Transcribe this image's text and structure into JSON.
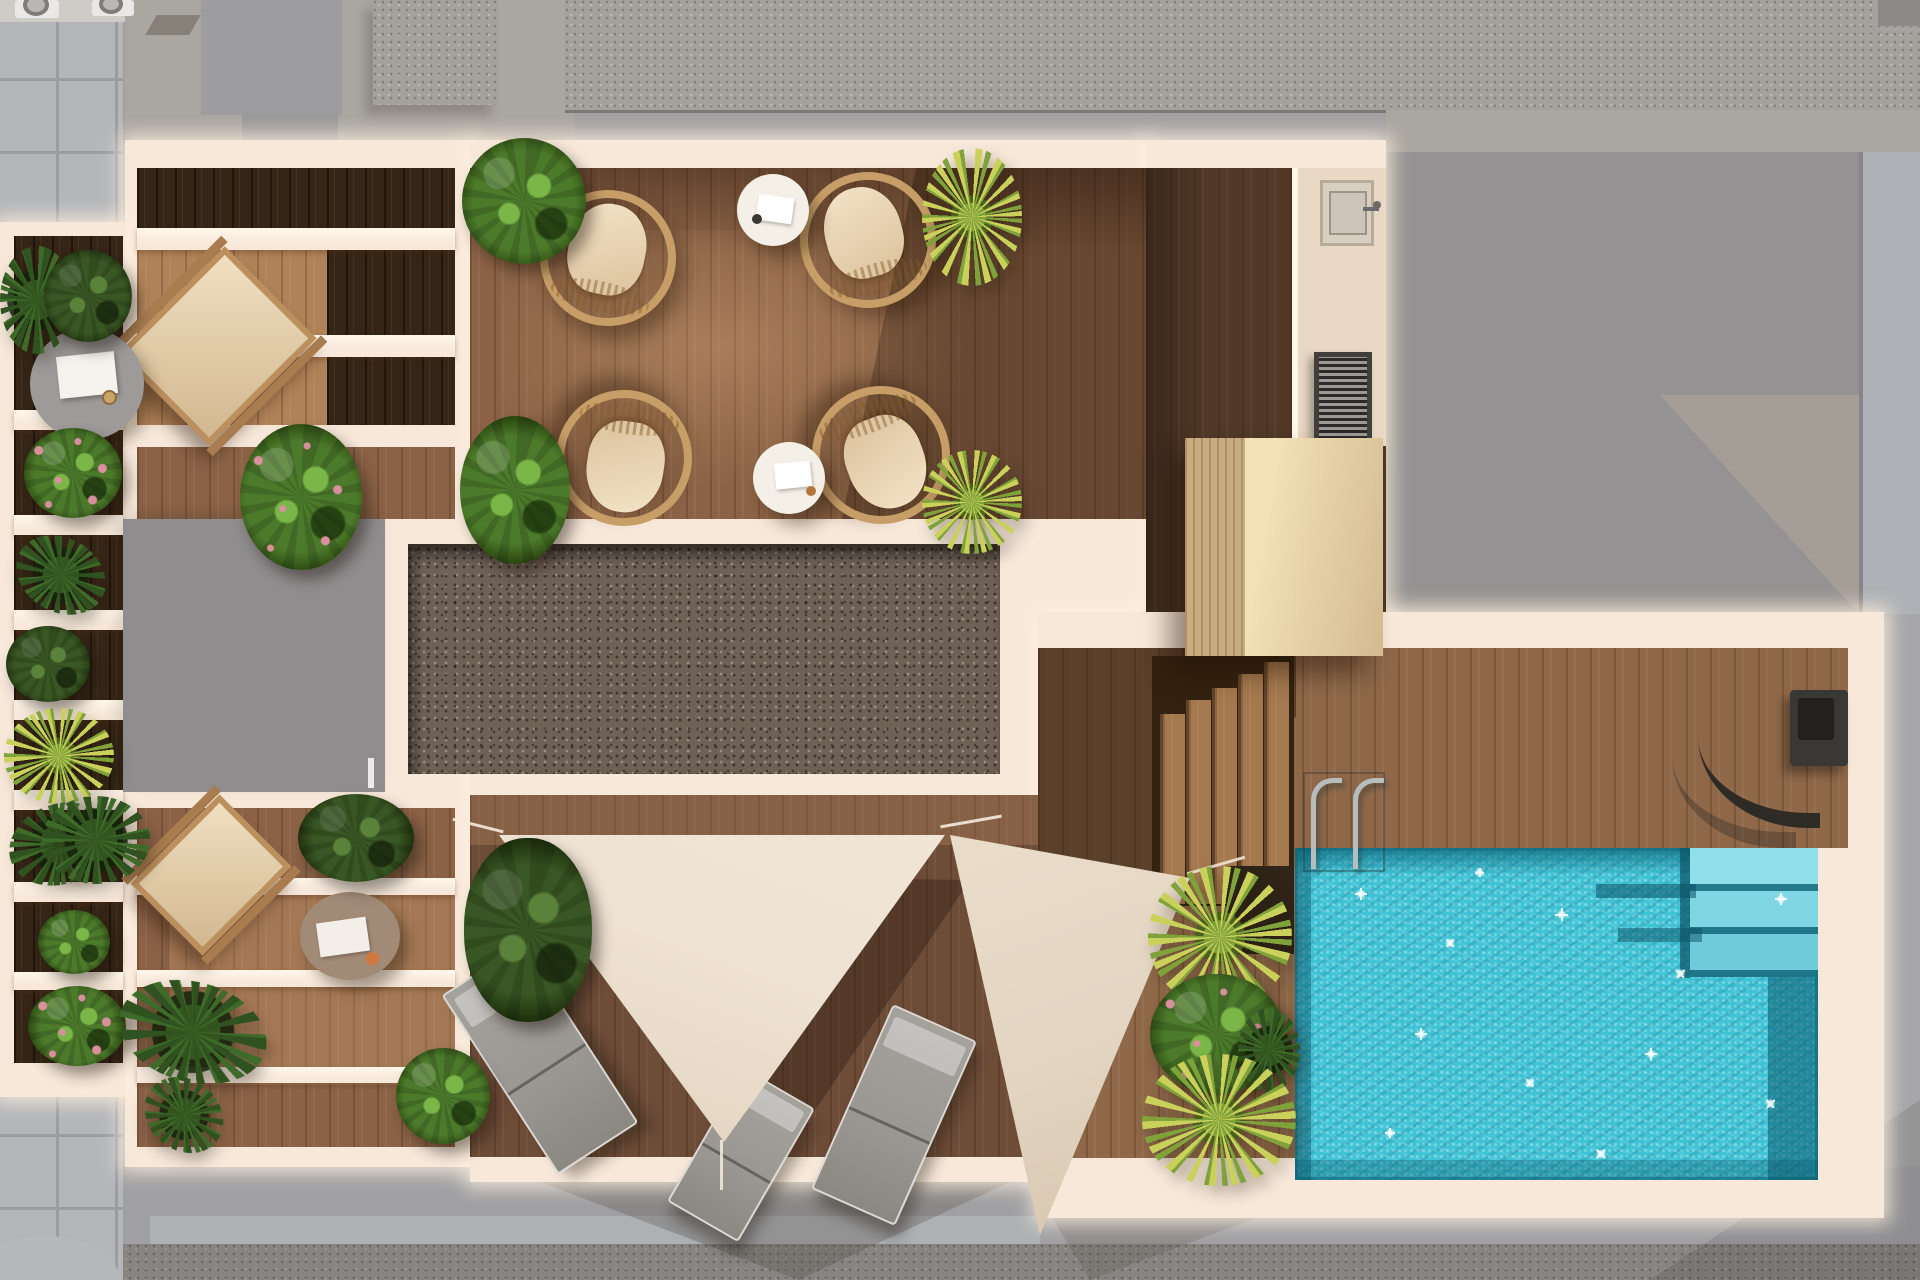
{
  "scene": {
    "title": "rooftop-terrace-floor-plan",
    "type": "architectural-top-down-3d-render",
    "description": "Top-down 3D architectural rendering of a rooftop terrace with swimming pool, wooden decks, pergola planters, gravel roof inset, shade sails and lounge furniture, surrounded by neighbouring grey rooftops"
  },
  "palette": {
    "cream": "#f7e8da",
    "creamBright": "#fff6ea",
    "surround": "#a2a0a2",
    "surroundDark": "#8e8c8b",
    "surroundLight": "#aeb1b4",
    "rightGray": "#949292",
    "rightGrayLight": "#a59e97",
    "rightBand": "#aeb1b5",
    "pavement": "#b4b6ba",
    "pavementLine": "#9b9da1",
    "speckRoof": "#a5a19d",
    "warmGray": "#aaa6a0",
    "roofBlock": "#9d9c9e",
    "grayBox": "#8f8d8e",
    "gravel": "#6e6156",
    "woodDark": "#352516",
    "deckMain": "#8b6246",
    "deckLight": "#b08257",
    "deckBottom": "#6d4c38",
    "deckPool": "#8f6849",
    "deckShadow": "#513827",
    "platformA": "#f2e0b6",
    "platformB": "#d9b67e",
    "concrete": "#e9d8c3",
    "steel": "#cdc5b9",
    "grillDark": "#413f3c",
    "poolWater": "#41c3d6",
    "poolDark": "#117e95",
    "poolShadow": "#0c6d82",
    "poolStep": "#8fe0ea",
    "sailA": "#eee2d2",
    "sailB": "#e3d5c2",
    "lounger": "#9a9792",
    "loungerEdge": "#dcd9d4",
    "wicker": "#c79e67",
    "cushion": "#efddc0",
    "tableWhite": "#f4efe7",
    "tableTaupe": "#a18a76",
    "tableGray": "#9d9a99",
    "showerDark": "#2e2b27",
    "woodRail": "#bb8f5e",
    "stepPlank": "#a5794f",
    "stepsBase": "#33220f",
    "bushGreen": "#4c7a2b",
    "bushLight": "#7ab648",
    "bushDark": "#2a450f",
    "palmYellow": "#c9d15a",
    "palmGreen": "#7fa23a",
    "leafDark": "#2f5220",
    "flowerPink": "#d9909c"
  },
  "areas": [
    {
      "id": "surroundings",
      "name": "neighbouring rooftops",
      "features": [
        "paved tile roof",
        "speckled gravel roofs",
        "ac-units",
        "diagonal sun shadows"
      ]
    },
    {
      "id": "pergola-terrace",
      "name": "upper pergola terrace",
      "features": [
        "dark timber floor",
        "cream pergola beams",
        "wooden deck chair",
        "grey side table"
      ]
    },
    {
      "id": "planter-gallery",
      "name": "left planter gallery",
      "features": [
        "stacked planter boxes",
        "mixed shrubs",
        "flowering plants",
        "yucca palms"
      ]
    },
    {
      "id": "main-lounge-deck",
      "name": "main lounge deck",
      "features": [
        "4 wicker armchairs",
        "2 white side tables",
        "box shrubs",
        "yucca palms"
      ]
    },
    {
      "id": "gravel-inset",
      "name": "gravel roof inset",
      "features": [
        "framed grey gravel field"
      ]
    },
    {
      "id": "stair-core",
      "name": "stair core roof",
      "features": [
        "flat grey cube",
        "hatch handle"
      ]
    },
    {
      "id": "kitchen-corridor",
      "name": "outdoor kitchen corridor",
      "features": [
        "sink unit",
        "grill vent",
        "concrete worktop strip"
      ]
    },
    {
      "id": "timber-platform",
      "name": "raised timber platform",
      "features": [
        "light slatted wood",
        "cast shadow"
      ]
    },
    {
      "id": "deck-stairs",
      "name": "deck stairs to pool level",
      "features": [
        "5 staggered plank treads"
      ]
    },
    {
      "id": "sail-deck",
      "name": "shade sail deck",
      "features": [
        "2 triangular shade sails",
        "3 grey sun loungers",
        "box shrub"
      ]
    },
    {
      "id": "lower-pergola-terrace",
      "name": "lower pergola terrace",
      "features": [
        "wooden deck chair",
        "taupe round table",
        "pergola beams",
        "plants"
      ]
    },
    {
      "id": "pool-deck",
      "name": "pool deck",
      "features": [
        "pool ladder",
        "outdoor shower",
        "planter bed with palms"
      ]
    },
    {
      "id": "pool",
      "name": "swimming pool",
      "features": [
        "turquoise water",
        "sun sparkles",
        "submerged corner steps"
      ]
    }
  ],
  "inventory": {
    "wicker_chairs": 4,
    "white_side_tables": 2,
    "wooden_deck_chairs": 2,
    "grey_side_table": 1,
    "taupe_side_table": 1,
    "sun_loungers": 3,
    "shade_sails": 2,
    "pools": 1,
    "pool_ladders": 1,
    "outdoor_showers": 1,
    "sink_units": 1,
    "grill_vents": 1,
    "deck_stair_treads": 5,
    "ac_units": 2,
    "plants_approx": 22
  }
}
